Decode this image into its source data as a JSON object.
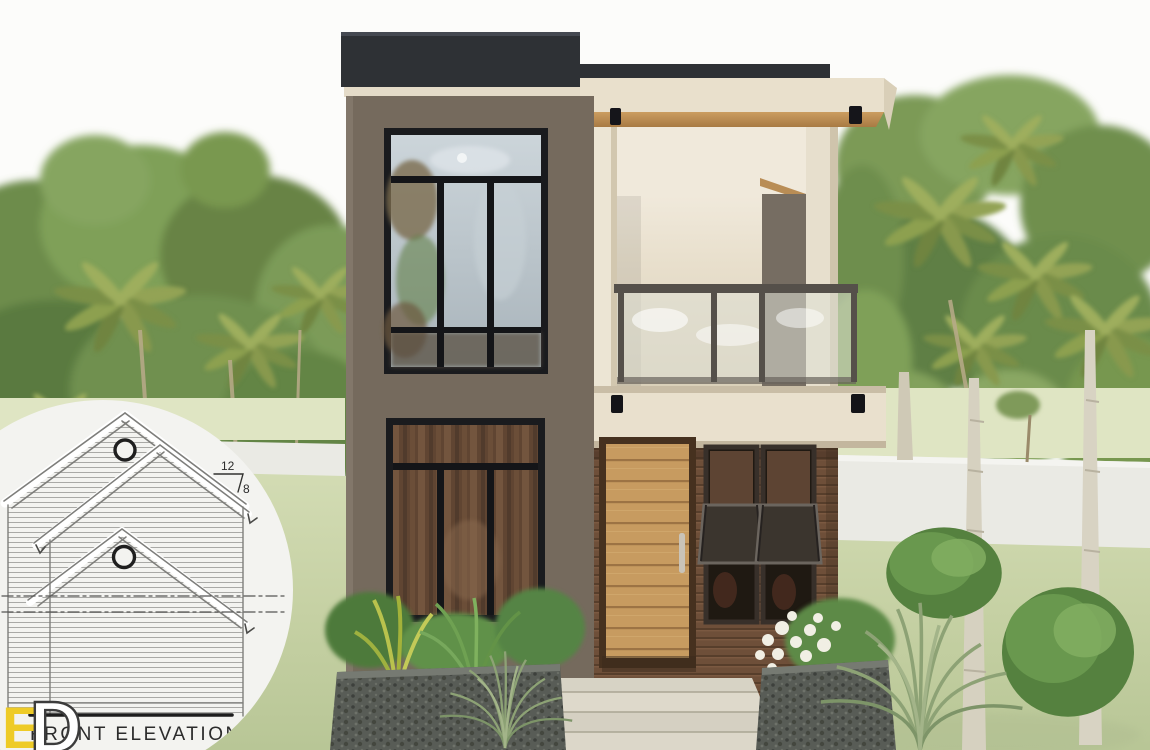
{
  "inset": {
    "caption": "FRONT ELEVATION",
    "pitch_rise": "12",
    "pitch_run": "8",
    "watermark_letters": [
      "E",
      "D"
    ]
  },
  "palette": {
    "sky": "#fcfcfa",
    "lawn": "#c3cfa0",
    "perimeter_wall": "#eaeae4",
    "facade_dark": "#756a5d",
    "parapet": "#2e3135",
    "facade_cream": "#e9e0cc",
    "soffit_wood": "#c0935a",
    "siding_wood": "#6e4f39",
    "door_wood": "#c79b60",
    "window_frame": "#1a1b1e",
    "glass": "#b9c4cb",
    "curtain": "#7c5a41",
    "railing_metal": "#55504a",
    "planter_stone": "#575b55",
    "foliage": "#6f9050",
    "drawing_line": "#8a8a8a",
    "logo_yellow": "#eecb27"
  }
}
